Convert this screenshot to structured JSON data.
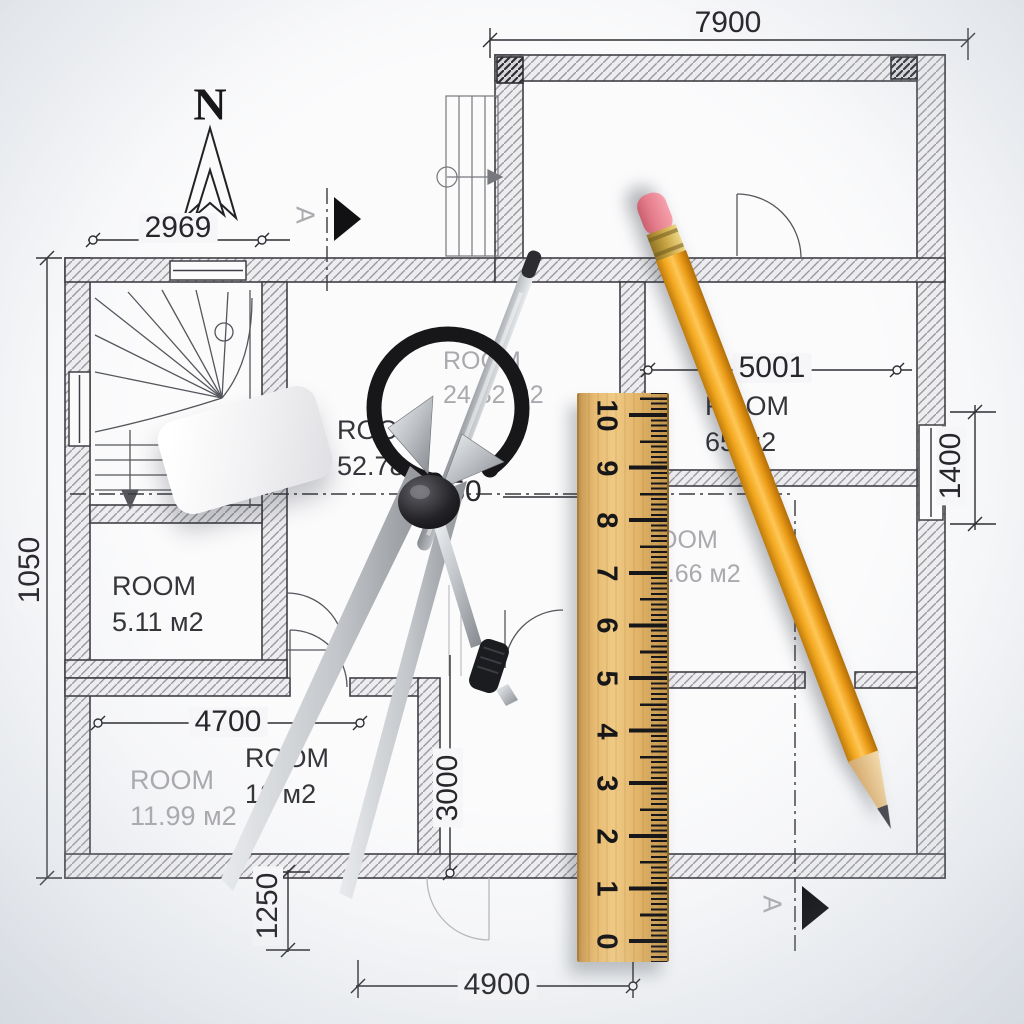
{
  "scene": {
    "title": "Architectural floor plan with drafting tools"
  },
  "north": {
    "label": "N"
  },
  "section": {
    "label": "A"
  },
  "dimensions": {
    "top_width": "7900",
    "upper_left_width": "2969",
    "right_room_width": "5001",
    "right_side_height": "1400",
    "left_side_height": "1050",
    "bottom_room_width": "4700",
    "inner_height": "3000",
    "bottom_left_height": "1250",
    "bottom_width": "4900",
    "center_partial": "50"
  },
  "rooms": {
    "hall": {
      "name": "ROOM",
      "area": "52.78"
    },
    "upper_center": {
      "name": "ROOM",
      "area": "24.82 м2"
    },
    "small_left": {
      "name": "ROOM",
      "area": "5.11 м2"
    },
    "bottom_left": {
      "name": "ROOM",
      "area": "11.99 м2"
    },
    "bottom_center": {
      "name": "ROOM",
      "area": "12 м2"
    },
    "right_center": {
      "name": "ROOM",
      "area": "32.66 м2"
    },
    "right_top": {
      "name": "ROOM",
      "area": "65 м2"
    }
  },
  "ruler": {
    "numbers": [
      "10",
      "9",
      "8",
      "7",
      "6",
      "5",
      "4",
      "3",
      "2",
      "1",
      "0"
    ]
  },
  "colors": {
    "paper": "#f6f6f8",
    "plan_line": "#2e2e33",
    "hatch": "#9a9aa0",
    "gray_text": "#a9a9ae",
    "pencil_body": "#f2a11d",
    "pencil_eraser": "#e8818f",
    "ruler_wood": "#e7bc72"
  }
}
